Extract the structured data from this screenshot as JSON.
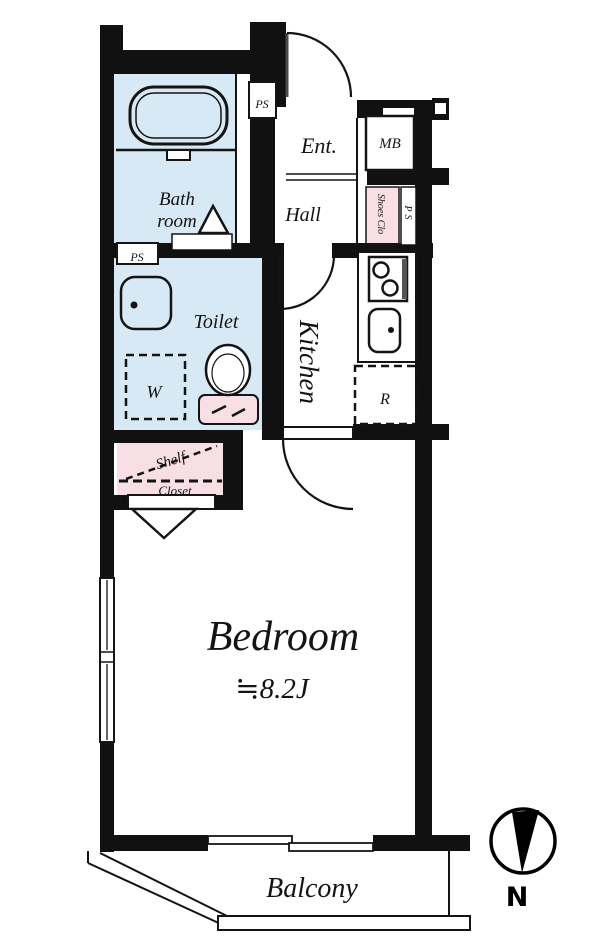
{
  "title": "apartment-floor-plan",
  "colors": {
    "wall": "#111111",
    "wet_area_blue": "#d7e9f4",
    "storage_pink": "#f8dfe6",
    "door_leaf_gray": "#4a4a4a"
  },
  "rooms": {
    "bath": {
      "line1": "Bath",
      "line2": "room"
    },
    "toilet": {
      "name": "Toilet"
    },
    "kitchen": {
      "name": "Kitchen"
    },
    "hall": {
      "name": "Hall"
    },
    "entrance": {
      "name": "Ent."
    },
    "bedroom": {
      "name": "Bedroom",
      "size": "≒8.2J"
    },
    "balcony": {
      "name": "Balcony"
    }
  },
  "labels": {
    "meter_box": "MB",
    "pipe_space_top": "PS",
    "pipe_space_toilet": "PS",
    "pipe_space_right": "PS",
    "shoes_closet": "Shoes Clo",
    "washer_space": "W",
    "refrigerator_space": "R",
    "shelf": "Shelf",
    "closet": "Closet",
    "compass_north": "N"
  }
}
